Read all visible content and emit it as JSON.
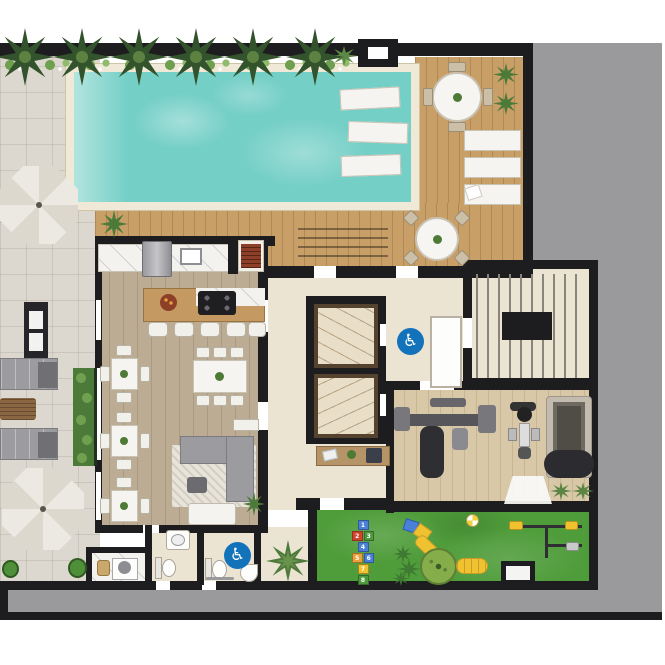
{
  "icons": {
    "accessibility": {
      "name": "wheelchair-icon",
      "glyph": "♿"
    }
  },
  "playground": {
    "hopscotch": [
      "1",
      "2",
      "3",
      "4",
      "5",
      "6",
      "7",
      "8"
    ]
  },
  "colors": {
    "wall": "#1d1d1f",
    "gray_bg": "#9a9a9c",
    "pavers": "#ddd8cf",
    "deck_wood": "#c99f68",
    "room_wood": "#bdac94",
    "gym_wood": "#d9c8a8",
    "beige": "#ece4d3",
    "marble": "#f4f2ee",
    "elevator_marble": "#e9dfc8",
    "pool_water": "#74cfc6",
    "pool_coping": "#f0e9d8",
    "grass": "#4f9c3a",
    "hedge": "#4c7a38",
    "palm": "#33532c",
    "accent_blue": "#1273bb",
    "sofa": "#9c9ca0",
    "island_wood": "#c49a62",
    "grill_red": "#8d3f27",
    "umbrella": "#e5e2da",
    "white_furniture": "#f5f4f0",
    "play_yellow": "#f0c230",
    "play_blue": "#4a80d8",
    "play_red": "#d0452c",
    "play_green": "#4d9a3d",
    "play_orange": "#e8a13c",
    "console_wood": "#b59468"
  }
}
